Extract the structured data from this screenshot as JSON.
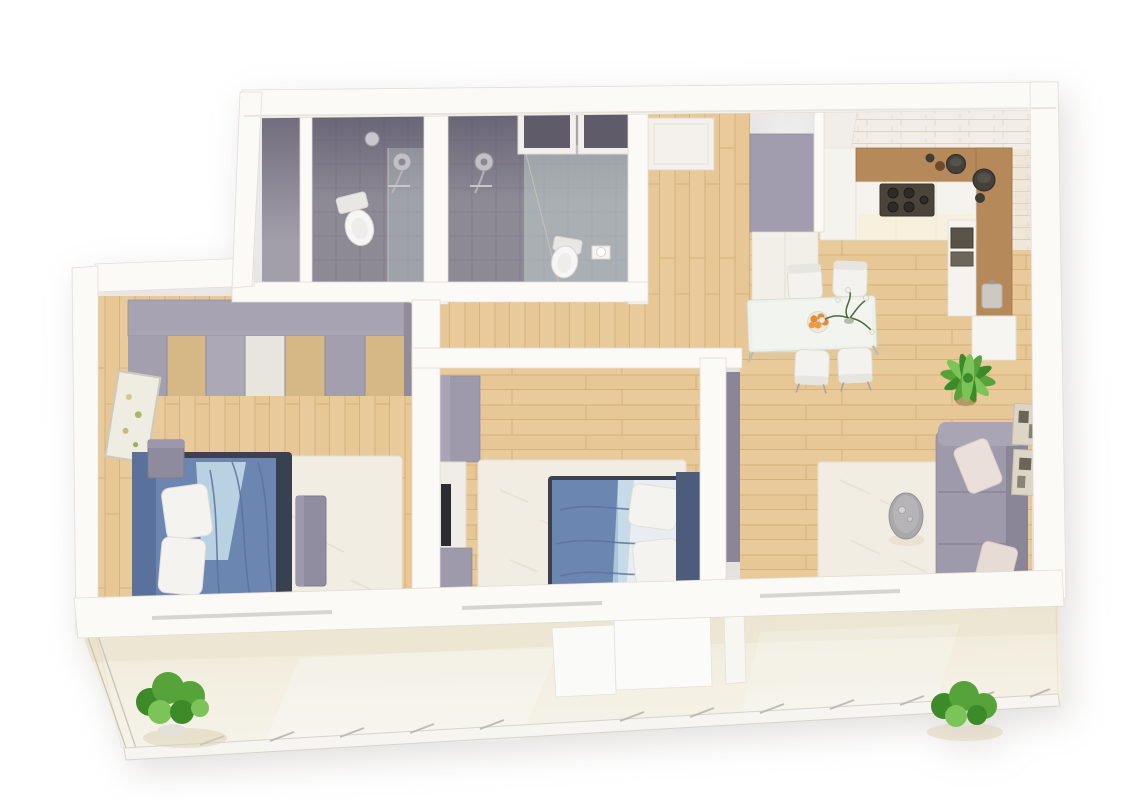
{
  "scene": {
    "type": "3d-floor-plan-render",
    "description": "Isometric 3D render of a two-bedroom apartment with two bathrooms, open kitchen-living area and a full-width balcony",
    "rooms": [
      {
        "id": "bathroom-1",
        "floor": "gray-tile",
        "items": [
          "toilet",
          "shower-head",
          "glass-shower-screen"
        ]
      },
      {
        "id": "bathroom-2",
        "floor": "gray-tile",
        "items": [
          "toilet",
          "shower-head",
          "glass-partition",
          "toilet-paper-holder",
          "dark-transom-panel",
          "dark-transom-panel"
        ]
      },
      {
        "id": "entry-hall",
        "floor": "wood",
        "items": [
          "entrance-door",
          "tall-closet"
        ]
      },
      {
        "id": "kitchen",
        "floor": "wood",
        "items": [
          "brick-backsplash",
          "l-shaped-counter",
          "cooktop",
          "oven",
          "cooking-pot",
          "cooking-pot",
          "sink",
          "tall-cabinet",
          "extractor-hood"
        ]
      },
      {
        "id": "dining-area",
        "floor": "wood",
        "items": [
          "dining-table",
          "chair",
          "chair",
          "chair",
          "chair",
          "fruit-bowl-with-oranges",
          "flower-vase"
        ]
      },
      {
        "id": "living-room",
        "floor": "wood",
        "items": [
          "sofa",
          "sofa-pillow",
          "sofa-pillow",
          "round-coffee-table",
          "area-rug",
          "wall-art",
          "wall-art",
          "potted-palm"
        ]
      },
      {
        "id": "bedroom-1",
        "floor": "wood",
        "items": [
          "double-bed",
          "pillow",
          "pillow",
          "striped-wardrobe",
          "nightstand",
          "bench",
          "area-rug",
          "picture-frame"
        ]
      },
      {
        "id": "bedroom-2",
        "floor": "wood",
        "items": [
          "double-bed",
          "pillow",
          "pillow",
          "sideboard",
          "low-cabinet",
          "wall-tv",
          "area-rug",
          "open-door-leaf"
        ]
      },
      {
        "id": "balcony",
        "floor": "cream-screed",
        "items": [
          "glass-railing",
          "railing-posts",
          "potted-plant",
          "potted-plant",
          "partition-wall",
          "door-threshold"
        ]
      }
    ]
  },
  "palette": {
    "bg": "#ffffff",
    "wall": "#fbfaf7",
    "wallLine": "#e3ded6",
    "wallShade": "#ece8e1",
    "wood": "#e9cb9b",
    "woodDark": "#dfbd87",
    "woodLine": "#d5b27b",
    "tile": "#8d8a96",
    "tileShadeTop": "#4f4a5e",
    "glass": "#c5d3d0",
    "accent": "#9e9aac",
    "accentDark": "#8a8698",
    "bedBlue": "#6c86b2",
    "bedBlueDark": "#5a729e",
    "sheetBlue": "#bdd6e5",
    "headboard": "#4d5c7a",
    "bedFrame": "#3c4150",
    "pillow": "#f5f3ef",
    "rug": "#f2ede2",
    "counterWood": "#b6895a",
    "applianceDark": "#4a443b",
    "white": "#f5f3ee",
    "plantGreen": "#55a339",
    "plantGreenDark": "#3c8b28",
    "plantGreenLight": "#7cc45a",
    "orange": "#e8892f",
    "balconyFloor": "#f5eedd",
    "balconyShade": "#e8ddc2",
    "tvBlack": "#2e2c33",
    "artBeige": "#ddd6c6",
    "toiletWhite": "#f7f6f4"
  }
}
